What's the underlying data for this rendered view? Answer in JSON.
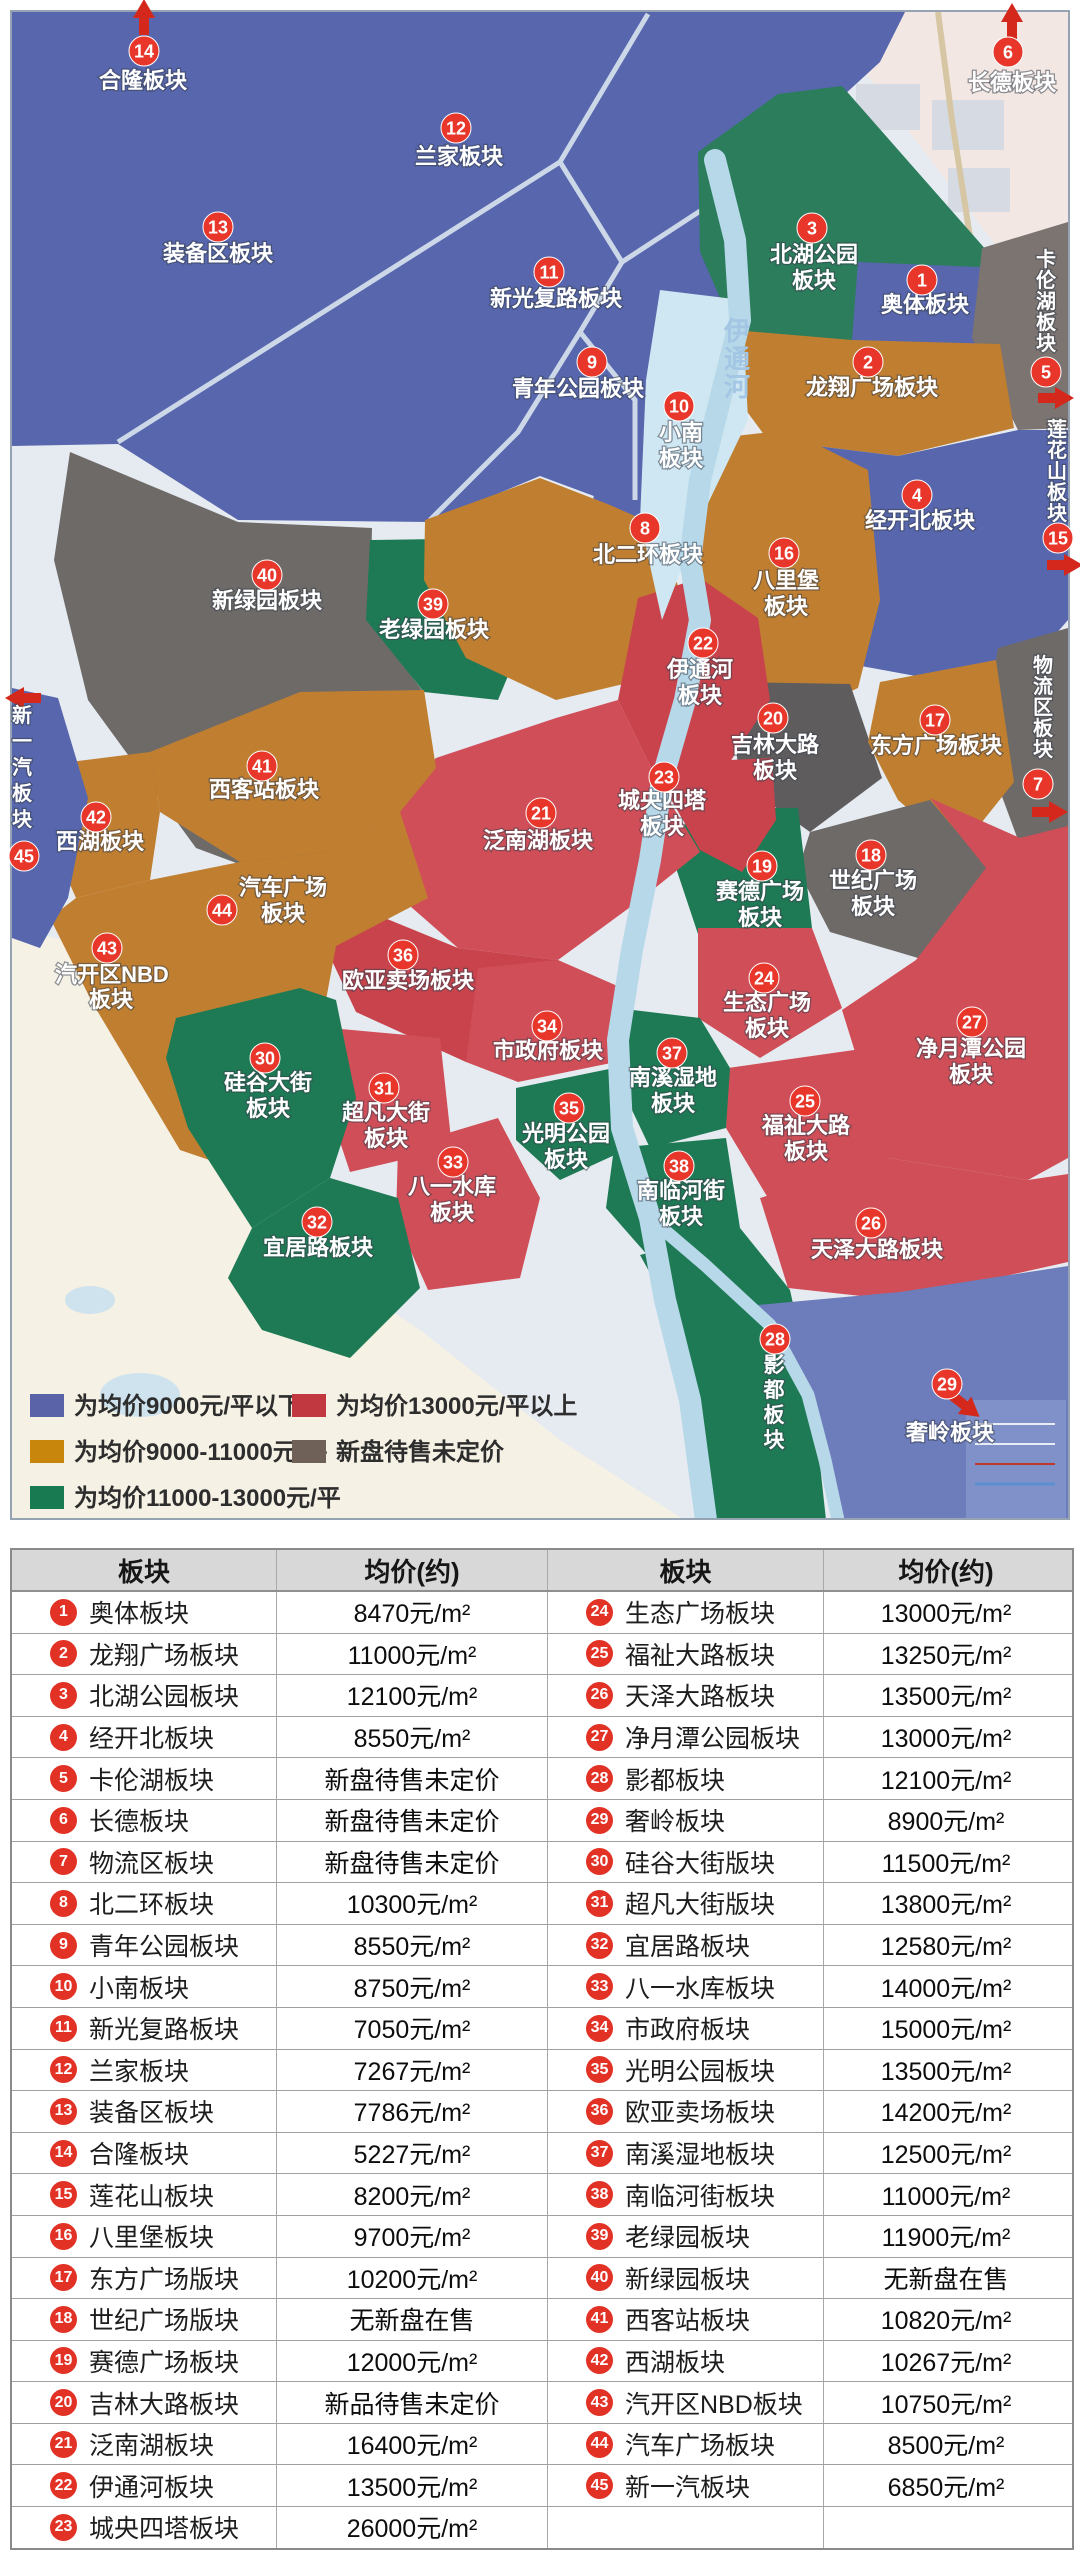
{
  "map": {
    "palette": {
      "blue": "#5766ad",
      "blue2": "#6d7cba",
      "orange": "#c07f30",
      "green": "#1e7a54",
      "green2": "#2b7d5c",
      "red": "#d04e57",
      "red2": "#c8434c",
      "gray": "#6e6a68",
      "gray2": "#7b7471",
      "gray3": "#5f5c5e",
      "river": "#b7d8e9",
      "base": "#e6ebf1",
      "cream": "#f5f1e5",
      "pink": "#f2e7e3",
      "road": "#ccd8e8",
      "marker": "#e8362b",
      "arrow": "#d4281c"
    },
    "water_label": {
      "t": "伊通河",
      "x": 737,
      "y": 340,
      "s": 28,
      "f": 26
    },
    "markers": [
      {
        "n": 1,
        "x": 922,
        "y": 280,
        "lines": [
          {
            "t": "奥体板块",
            "x": 925,
            "y": 312
          }
        ]
      },
      {
        "n": 2,
        "x": 868,
        "y": 362,
        "lines": [
          {
            "t": "龙翔广场板块",
            "x": 872,
            "y": 395
          }
        ]
      },
      {
        "n": 3,
        "x": 812,
        "y": 228,
        "lines": [
          {
            "t": "北湖公园",
            "x": 814,
            "y": 262
          },
          {
            "t": "板块",
            "x": 814,
            "y": 288
          }
        ]
      },
      {
        "n": 4,
        "x": 917,
        "y": 495,
        "lines": [
          {
            "t": "经开北板块",
            "x": 920,
            "y": 528
          }
        ]
      },
      {
        "n": 5,
        "x": 1046,
        "y": 372,
        "lines": [
          {
            "t": "卡伦湖板块",
            "x": 1046,
            "y": 266,
            "v": 1,
            "s": 21,
            "f": 20
          }
        ]
      },
      {
        "n": 6,
        "x": 1008,
        "y": 52,
        "lines": [
          {
            "t": "长德板块",
            "x": 1012,
            "y": 90
          }
        ]
      },
      {
        "n": 7,
        "x": 1038,
        "y": 784,
        "lines": [
          {
            "t": "物流区板块",
            "x": 1043,
            "y": 672,
            "v": 1,
            "s": 21,
            "f": 20
          }
        ]
      },
      {
        "n": 8,
        "x": 645,
        "y": 528,
        "lines": [
          {
            "t": "北二环板块",
            "x": 648,
            "y": 562
          }
        ]
      },
      {
        "n": 9,
        "x": 592,
        "y": 362,
        "lines": [
          {
            "t": "青年公园板块",
            "x": 578,
            "y": 396
          }
        ]
      },
      {
        "n": 10,
        "x": 679,
        "y": 406,
        "lines": [
          {
            "t": "小南",
            "x": 681,
            "y": 440
          },
          {
            "t": "板块",
            "x": 681,
            "y": 466
          }
        ]
      },
      {
        "n": 11,
        "x": 549,
        "y": 272,
        "lines": [
          {
            "t": "新光复路板块",
            "x": 556,
            "y": 306
          }
        ]
      },
      {
        "n": 12,
        "x": 456,
        "y": 128,
        "lines": [
          {
            "t": "兰家板块",
            "x": 459,
            "y": 164
          }
        ]
      },
      {
        "n": 13,
        "x": 218,
        "y": 227,
        "lines": [
          {
            "t": "装备区板块",
            "x": 218,
            "y": 261
          }
        ]
      },
      {
        "n": 14,
        "x": 144,
        "y": 51,
        "lines": [
          {
            "t": "合隆板块",
            "x": 143,
            "y": 88
          }
        ]
      },
      {
        "n": 15,
        "x": 1058,
        "y": 538,
        "lines": [
          {
            "t": "莲花山板块",
            "x": 1057,
            "y": 436,
            "v": 1,
            "s": 21,
            "f": 20
          }
        ]
      },
      {
        "n": 16,
        "x": 784,
        "y": 553,
        "lines": [
          {
            "t": "八里堡",
            "x": 786,
            "y": 588
          },
          {
            "t": "板块",
            "x": 786,
            "y": 614
          }
        ]
      },
      {
        "n": 17,
        "x": 935,
        "y": 720,
        "lines": [
          {
            "t": "东方广场板块",
            "x": 936,
            "y": 753
          }
        ]
      },
      {
        "n": 18,
        "x": 871,
        "y": 855,
        "lines": [
          {
            "t": "世纪广场",
            "x": 873,
            "y": 888
          },
          {
            "t": "板块",
            "x": 873,
            "y": 914
          }
        ]
      },
      {
        "n": 19,
        "x": 762,
        "y": 866,
        "lines": [
          {
            "t": "赛德广场",
            "x": 760,
            "y": 899
          },
          {
            "t": "板块",
            "x": 760,
            "y": 925
          }
        ]
      },
      {
        "n": 20,
        "x": 773,
        "y": 718,
        "lines": [
          {
            "t": "吉林大路",
            "x": 775,
            "y": 752
          },
          {
            "t": "板块",
            "x": 775,
            "y": 778
          }
        ]
      },
      {
        "n": 21,
        "x": 541,
        "y": 813,
        "lines": [
          {
            "t": "泛南湖板块",
            "x": 538,
            "y": 848
          }
        ]
      },
      {
        "n": 22,
        "x": 703,
        "y": 643,
        "lines": [
          {
            "t": "伊通河",
            "x": 700,
            "y": 677
          },
          {
            "t": "板块",
            "x": 700,
            "y": 703
          }
        ]
      },
      {
        "n": 23,
        "x": 664,
        "y": 777,
        "lines": [
          {
            "t": "城央四塔",
            "x": 662,
            "y": 808
          },
          {
            "t": "板块",
            "x": 662,
            "y": 834
          }
        ]
      },
      {
        "n": 24,
        "x": 764,
        "y": 978,
        "lines": [
          {
            "t": "生态广场",
            "x": 767,
            "y": 1010
          },
          {
            "t": "板块",
            "x": 767,
            "y": 1036
          }
        ]
      },
      {
        "n": 25,
        "x": 805,
        "y": 1101,
        "lines": [
          {
            "t": "福祉大路",
            "x": 806,
            "y": 1133
          },
          {
            "t": "板块",
            "x": 806,
            "y": 1159
          }
        ]
      },
      {
        "n": 26,
        "x": 871,
        "y": 1223,
        "lines": [
          {
            "t": "天泽大路板块",
            "x": 877,
            "y": 1257
          }
        ]
      },
      {
        "n": 27,
        "x": 972,
        "y": 1022,
        "lines": [
          {
            "t": "净月潭公园",
            "x": 971,
            "y": 1056
          },
          {
            "t": "板块",
            "x": 971,
            "y": 1082
          }
        ]
      },
      {
        "n": 28,
        "x": 775,
        "y": 1339,
        "lines": [
          {
            "t": "影都板块",
            "x": 774,
            "y": 1372,
            "v": 1,
            "s": 25,
            "f": 21
          }
        ]
      },
      {
        "n": 29,
        "x": 947,
        "y": 1384,
        "lines": [
          {
            "t": "奢岭板块",
            "x": 950,
            "y": 1440
          }
        ]
      },
      {
        "n": 30,
        "x": 265,
        "y": 1058,
        "lines": [
          {
            "t": "硅谷大街",
            "x": 268,
            "y": 1090
          },
          {
            "t": "板块",
            "x": 268,
            "y": 1116
          }
        ]
      },
      {
        "n": 31,
        "x": 384,
        "y": 1088,
        "lines": [
          {
            "t": "超凡大街",
            "x": 386,
            "y": 1120
          },
          {
            "t": "板块",
            "x": 386,
            "y": 1146
          }
        ]
      },
      {
        "n": 32,
        "x": 317,
        "y": 1222,
        "lines": [
          {
            "t": "宜居路板块",
            "x": 318,
            "y": 1255
          }
        ]
      },
      {
        "n": 33,
        "x": 453,
        "y": 1162,
        "lines": [
          {
            "t": "八一水库",
            "x": 452,
            "y": 1194
          },
          {
            "t": "板块",
            "x": 452,
            "y": 1220
          }
        ]
      },
      {
        "n": 34,
        "x": 547,
        "y": 1026,
        "lines": [
          {
            "t": "市政府板块",
            "x": 548,
            "y": 1058
          }
        ]
      },
      {
        "n": 35,
        "x": 569,
        "y": 1108,
        "lines": [
          {
            "t": "光明公园",
            "x": 566,
            "y": 1141
          },
          {
            "t": "板块",
            "x": 566,
            "y": 1167
          }
        ]
      },
      {
        "n": 36,
        "x": 403,
        "y": 955,
        "lines": [
          {
            "t": "欧亚卖场板块",
            "x": 408,
            "y": 988
          }
        ]
      },
      {
        "n": 37,
        "x": 672,
        "y": 1053,
        "lines": [
          {
            "t": "南溪湿地",
            "x": 673,
            "y": 1085
          },
          {
            "t": "板块",
            "x": 673,
            "y": 1111
          }
        ]
      },
      {
        "n": 38,
        "x": 679,
        "y": 1166,
        "lines": [
          {
            "t": "南临河街",
            "x": 681,
            "y": 1198
          },
          {
            "t": "板块",
            "x": 681,
            "y": 1224
          }
        ]
      },
      {
        "n": 39,
        "x": 433,
        "y": 604,
        "lines": [
          {
            "t": "老绿园板块",
            "x": 434,
            "y": 637
          }
        ]
      },
      {
        "n": 40,
        "x": 267,
        "y": 575,
        "lines": [
          {
            "t": "新绿园板块",
            "x": 267,
            "y": 608
          }
        ]
      },
      {
        "n": 41,
        "x": 262,
        "y": 766,
        "lines": [
          {
            "t": "西客站板块",
            "x": 264,
            "y": 797
          }
        ]
      },
      {
        "n": 42,
        "x": 96,
        "y": 817,
        "lines": [
          {
            "t": "西湖板块",
            "x": 100,
            "y": 849
          }
        ]
      },
      {
        "n": 43,
        "x": 107,
        "y": 948,
        "lines": [
          {
            "t": "汽开区NBD",
            "x": 112,
            "y": 982
          },
          {
            "t": "板块",
            "x": 111,
            "y": 1007
          }
        ]
      },
      {
        "n": 44,
        "x": 222,
        "y": 910,
        "lines": [
          {
            "t": "汽车广场",
            "x": 283,
            "y": 895
          },
          {
            "t": "板块",
            "x": 283,
            "y": 921
          }
        ]
      },
      {
        "n": 45,
        "x": 24,
        "y": 856,
        "lines": [
          {
            "t": "新一汽板块",
            "x": 22,
            "y": 722,
            "v": 1,
            "s": 26,
            "f": 20
          }
        ]
      }
    ],
    "arrows": [
      {
        "x": 144,
        "y": 20,
        "a": -90
      },
      {
        "x": 1012,
        "y": 24,
        "a": -90
      },
      {
        "x": 1053,
        "y": 398,
        "a": 0
      },
      {
        "x": 1062,
        "y": 565,
        "a": 0
      },
      {
        "x": 1047,
        "y": 812,
        "a": 0
      },
      {
        "x": 26,
        "y": 698,
        "a": 180
      },
      {
        "x": 963,
        "y": 1404,
        "a": 38
      }
    ]
  },
  "legend": {
    "items": [
      {
        "color": "#5a63a8",
        "label": "为均价9000元/平以下",
        "x": 30,
        "y": 1394
      },
      {
        "color": "#c8860d",
        "label": "为均价9000-11000元/平",
        "x": 30,
        "y": 1440
      },
      {
        "color": "#187a50",
        "label": "为均价11000-13000元/平",
        "x": 30,
        "y": 1486
      },
      {
        "color": "#c23840",
        "label": "为均价13000元/平以上",
        "x": 292,
        "y": 1394
      },
      {
        "color": "#6f6158",
        "label": "新盘待售未定价",
        "x": 292,
        "y": 1440
      }
    ]
  },
  "table": {
    "headers": [
      "板块",
      "均价(约)",
      "板块",
      "均价(约)"
    ],
    "rows": [
      {
        "l": {
          "n": "1",
          "name": "奥体板块",
          "price": "8470元/m²"
        },
        "r": {
          "n": "24",
          "name": "生态广场板块",
          "price": "13000元/m²"
        }
      },
      {
        "l": {
          "n": "2",
          "name": "龙翔广场板块",
          "price": "11000元/m²"
        },
        "r": {
          "n": "25",
          "name": "福祉大路板块",
          "price": "13250元/m²"
        }
      },
      {
        "l": {
          "n": "3",
          "name": "北湖公园板块",
          "price": "12100元/m²"
        },
        "r": {
          "n": "26",
          "name": "天泽大路板块",
          "price": "13500元/m²"
        }
      },
      {
        "l": {
          "n": "4",
          "name": "经开北板块",
          "price": "8550元/m²"
        },
        "r": {
          "n": "27",
          "name": "净月潭公园板块",
          "price": "13000元/m²"
        }
      },
      {
        "l": {
          "n": "5",
          "name": "卡伦湖板块",
          "price": "新盘待售未定价"
        },
        "r": {
          "n": "28",
          "name": "影都板块",
          "price": "12100元/m²"
        }
      },
      {
        "l": {
          "n": "6",
          "name": "长德板块",
          "price": "新盘待售未定价"
        },
        "r": {
          "n": "29",
          "name": "奢岭板块",
          "price": "8900元/m²"
        }
      },
      {
        "l": {
          "n": "7",
          "name": "物流区板块",
          "price": "新盘待售未定价"
        },
        "r": {
          "n": "30",
          "name": "硅谷大街版块",
          "price": "11500元/m²"
        }
      },
      {
        "l": {
          "n": "8",
          "name": "北二环板块",
          "price": "10300元/m²"
        },
        "r": {
          "n": "31",
          "name": "超凡大街版块",
          "price": "13800元/m²"
        }
      },
      {
        "l": {
          "n": "9",
          "name": "青年公园板块",
          "price": "8550元/m²"
        },
        "r": {
          "n": "32",
          "name": "宜居路板块",
          "price": "12580元/m²"
        }
      },
      {
        "l": {
          "n": "10",
          "name": "小南板块",
          "price": "8750元/m²"
        },
        "r": {
          "n": "33",
          "name": "八一水库板块",
          "price": "14000元/m²"
        }
      },
      {
        "l": {
          "n": "11",
          "name": "新光复路板块",
          "price": "7050元/m²"
        },
        "r": {
          "n": "34",
          "name": "市政府板块",
          "price": "15000元/m²"
        }
      },
      {
        "l": {
          "n": "12",
          "name": "兰家板块",
          "price": "7267元/m²"
        },
        "r": {
          "n": "35",
          "name": "光明公园板块",
          "price": "13500元/m²"
        }
      },
      {
        "l": {
          "n": "13",
          "name": "装备区板块",
          "price": "7786元/m²"
        },
        "r": {
          "n": "36",
          "name": "欧亚卖场板块",
          "price": "14200元/m²"
        }
      },
      {
        "l": {
          "n": "14",
          "name": "合隆板块",
          "price": "5227元/m²"
        },
        "r": {
          "n": "37",
          "name": "南溪湿地板块",
          "price": "12500元/m²"
        }
      },
      {
        "l": {
          "n": "15",
          "name": "莲花山板块",
          "price": "8200元/m²"
        },
        "r": {
          "n": "38",
          "name": "南临河街板块",
          "price": "11000元/m²"
        }
      },
      {
        "l": {
          "n": "16",
          "name": "八里堡板块",
          "price": "9700元/m²"
        },
        "r": {
          "n": "39",
          "name": "老绿园板块",
          "price": "11900元/m²"
        }
      },
      {
        "l": {
          "n": "17",
          "name": "东方广场版块",
          "price": "10200元/m²"
        },
        "r": {
          "n": "40",
          "name": "新绿园板块",
          "price": "无新盘在售"
        }
      },
      {
        "l": {
          "n": "18",
          "name": "世纪广场版块",
          "price": "无新盘在售"
        },
        "r": {
          "n": "41",
          "name": "西客站板块",
          "price": "10820元/m²"
        }
      },
      {
        "l": {
          "n": "19",
          "name": "赛德广场板块",
          "price": "12000元/m²"
        },
        "r": {
          "n": "42",
          "name": "西湖板块",
          "price": "10267元/m²"
        }
      },
      {
        "l": {
          "n": "20",
          "name": "吉林大路板块",
          "price": "新品待售未定价"
        },
        "r": {
          "n": "43",
          "name": "汽开区NBD板块",
          "price": "10750元/m²"
        }
      },
      {
        "l": {
          "n": "21",
          "name": "泛南湖板块",
          "price": "16400元/m²"
        },
        "r": {
          "n": "44",
          "name": "汽车广场板块",
          "price": "8500元/m²"
        }
      },
      {
        "l": {
          "n": "22",
          "name": "伊通河板块",
          "price": "13500元/m²"
        },
        "r": {
          "n": "45",
          "name": "新一汽板块",
          "price": "6850元/m²"
        }
      },
      {
        "l": {
          "n": "23",
          "name": "城央四塔板块",
          "price": "26000元/m²"
        },
        "r": null
      }
    ]
  }
}
